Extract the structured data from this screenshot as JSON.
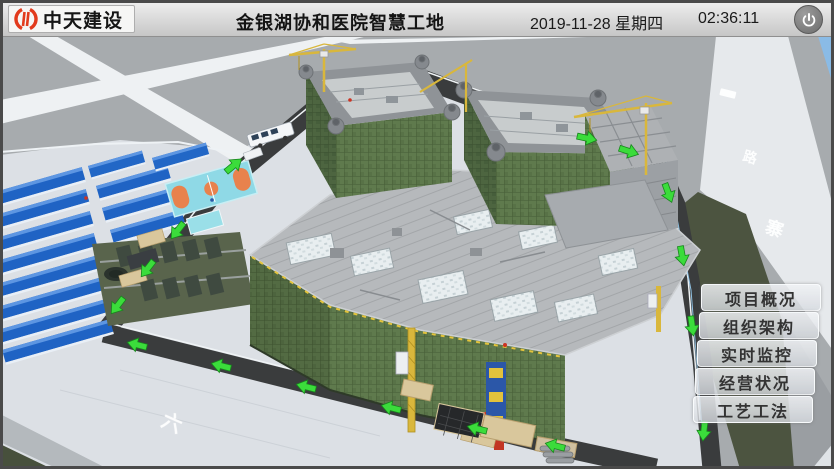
{
  "header": {
    "logo_text": "中天建设",
    "title": "金银湖协和医院智慧工地",
    "date": "2019-11-28 星期四",
    "time": "02:36:11"
  },
  "menu": {
    "items": [
      {
        "label": "项目概况"
      },
      {
        "label": "组织架构"
      },
      {
        "label": "实时监控"
      },
      {
        "label": "经营状况"
      },
      {
        "label": "工艺工法"
      }
    ]
  },
  "scene": {
    "type": "3d-construction-site-model",
    "road_markings": [
      "路",
      "寨",
      "六"
    ],
    "colors": {
      "ground": "#a7abae",
      "pavement": "#dce0e5",
      "road_dark": "#3a3c3d",
      "road_light": "#e6e9ec",
      "grass": "#4c5440",
      "arrow_green": "#3bdc3b",
      "scaffold_net": "#5f7a4d",
      "deck": "#b6b9bc",
      "camp_roof": "#1f63c4",
      "court": "#8fd9e6",
      "crane_yellow": "#d9b73c",
      "sky": "#8abbe6"
    },
    "elements": [
      "worker-camp",
      "basketball-court",
      "parking-field",
      "main-hospital-building",
      "tower-cranes",
      "construction-hoists",
      "material-yard",
      "perimeter-roads"
    ]
  }
}
